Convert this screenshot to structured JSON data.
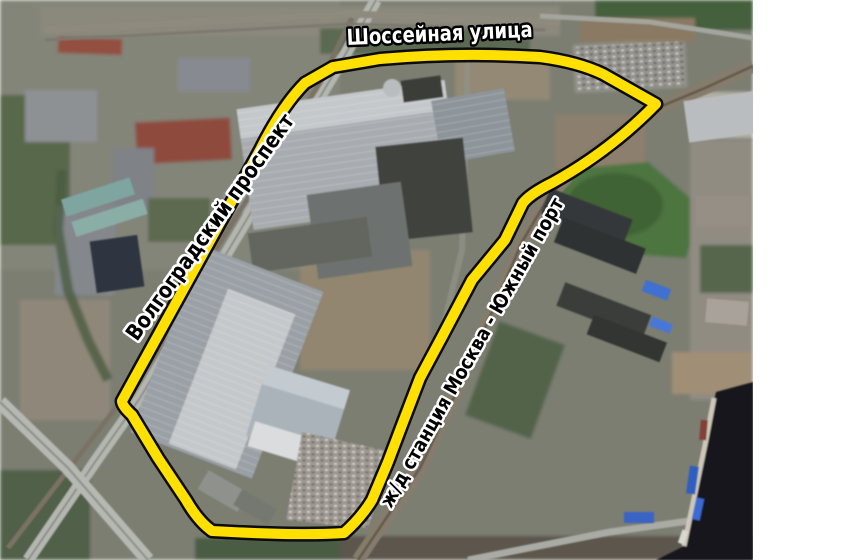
{
  "map": {
    "type": "annotated-satellite-aerial-photo",
    "labels": {
      "top_street": "Шоссейная улица",
      "left_avenue": "Волгоградский проспект",
      "right_railway": "ж/д станция Москва - Южный порт"
    },
    "boundary": {
      "stroke_color": "#FFE000",
      "outline_color": "#0B0B0B"
    },
    "label_styles": {
      "top_street_fill": "#FFFFFF",
      "top_street_outline": "#000000",
      "side_fill": "#000000",
      "side_outline": "#FFFFFF"
    },
    "palette": {
      "terrain_base": "#7B7E72",
      "vegetation": "#4D7440",
      "roof_light": "#A7ACB0",
      "roof_bright": "#C8CBCD",
      "roof_dark": "#3F423E",
      "road": "#B4B6B0",
      "railway": "#867C6C",
      "dirt": "#97876F",
      "water": "#17191C",
      "margin": "#FFFFFF"
    }
  }
}
